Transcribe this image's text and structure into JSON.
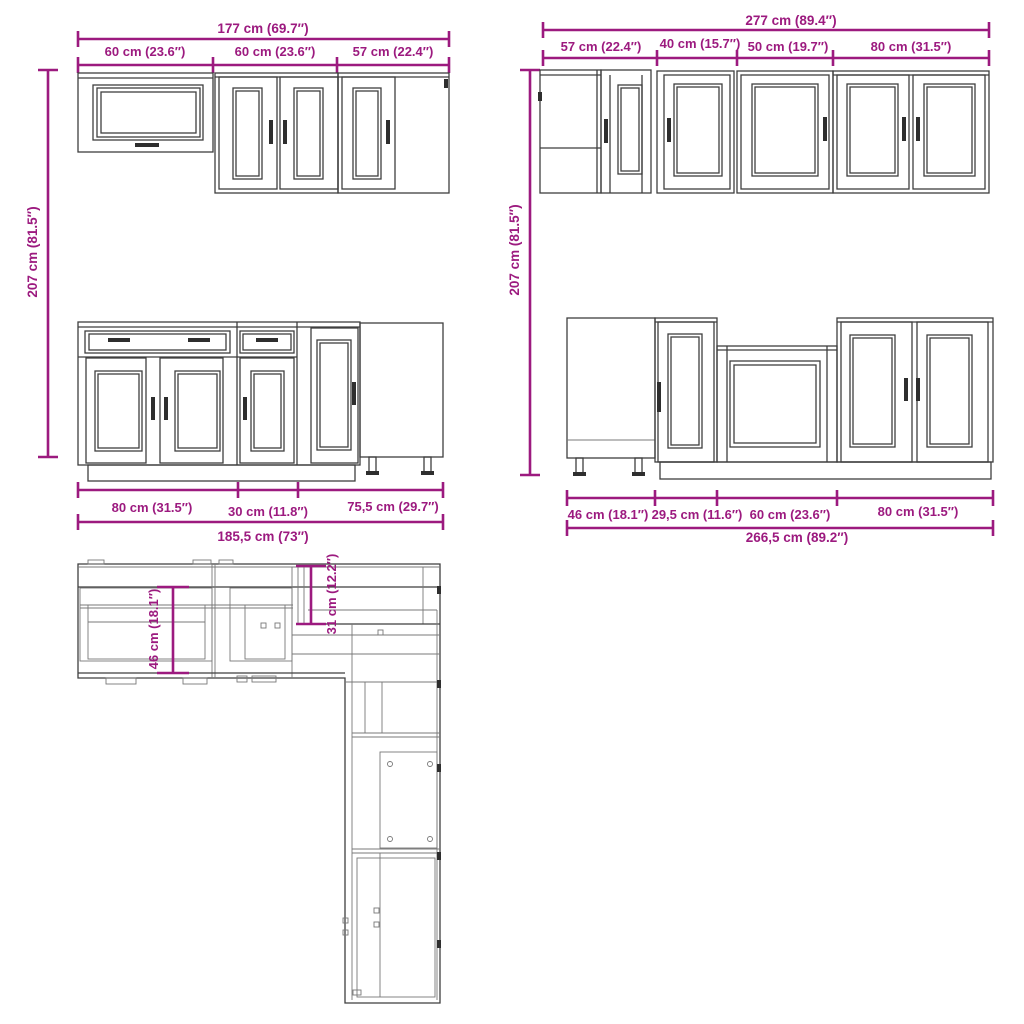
{
  "colors": {
    "dimension": "#9c1a7f",
    "line": "#3f3f3f"
  },
  "views": {
    "wall_left": {
      "total_width": "177 cm (69.7″)",
      "segments": [
        "60 cm (23.6″)",
        "60 cm (23.6″)",
        "57 cm (22.4″)"
      ],
      "height": "207 cm (81.5″)"
    },
    "wall_right": {
      "total_width": "277 cm (89.4″)",
      "segments": [
        "57 cm (22.4″)",
        "40 cm (15.7″)",
        "50 cm (19.7″)",
        "80 cm (31.5″)"
      ],
      "height": "207 cm (81.5″)"
    },
    "base_left": {
      "segments": [
        "80 cm (31.5″)",
        "30 cm (11.8″)",
        "75,5 cm (29.7″)"
      ],
      "total_width": "185,5 cm (73″)"
    },
    "base_right": {
      "segments": [
        "46 cm (18.1″)",
        "29,5 cm (11.6″)",
        "60 cm (23.6″)",
        "80 cm (31.5″)"
      ],
      "total_width": "266,5 cm (89.2″)"
    },
    "plan": {
      "base_depth": "46 cm (18.1″)",
      "wall_depth": "31 cm (12.2″)"
    }
  }
}
